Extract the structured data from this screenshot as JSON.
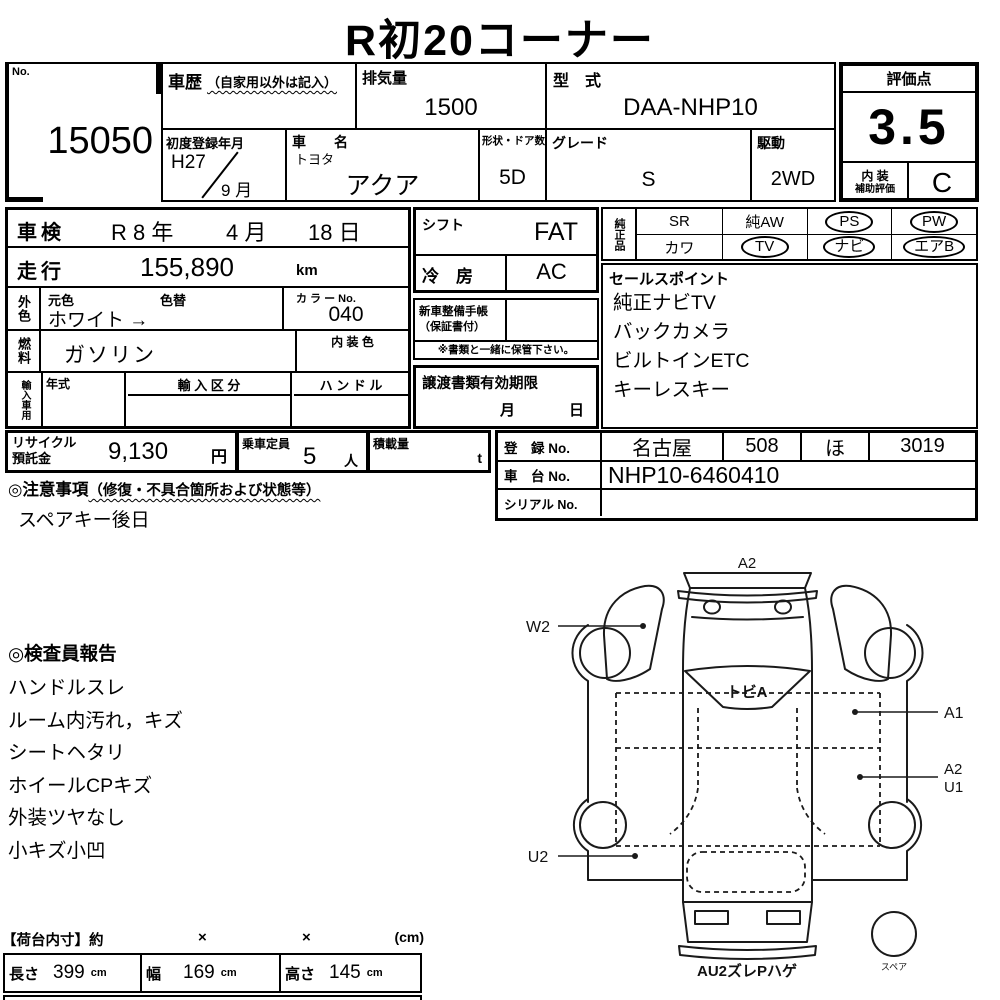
{
  "title": "R初20コーナー",
  "header": {
    "no": {
      "label": "No.",
      "value": "15050"
    },
    "history": {
      "label": "車歴",
      "note": "（自家用以外は記入）"
    },
    "displacement": {
      "label": "排気量",
      "value": "1500"
    },
    "model_code": {
      "label": "型　式",
      "value": "DAA-NHP10"
    },
    "first_reg": {
      "label": "初度登録年月",
      "year": "H27",
      "month": "9 月"
    },
    "car_name": {
      "label": "車　　名",
      "maker": "トヨタ",
      "model": "アクア"
    },
    "doors": {
      "label": "形状・ドア数",
      "value": "5D"
    },
    "grade": {
      "label": "グレード",
      "value": "S"
    },
    "drive": {
      "label": "駆動",
      "value": "2WD"
    }
  },
  "score": {
    "label": "評価点",
    "value": "3.5",
    "interior_label": "内 装",
    "interior_sublabel": "補助評価",
    "interior_value": "C"
  },
  "left": {
    "shaken": {
      "label": "車検",
      "year": "R 8 年",
      "month": "4 月",
      "day": "18 日"
    },
    "mileage": {
      "label": "走行",
      "value": "155,890",
      "unit": "km"
    },
    "ext_color": {
      "label": "外色",
      "orig_label": "元色",
      "change_label": "色替",
      "value": "ホワイト →",
      "color_no_label": "カ ラ ー No.",
      "color_no": "040"
    },
    "fuel": {
      "label": "燃料",
      "value": "ガソリン",
      "interior_color_label": "内 装 色"
    },
    "import": {
      "label": "輸入車用",
      "year_label": "年式",
      "division_label": "輸 入 区 分",
      "handle_label": "ハ ン ド ル"
    }
  },
  "middle": {
    "shift": {
      "label": "シフト",
      "value": "FAT"
    },
    "ac": {
      "label": "冷　房",
      "value": "AC"
    },
    "service_book": {
      "label1": "新車整備手帳",
      "label2": "（保証書付）",
      "note": "※書類と一緒に保管下さい。"
    },
    "transfer": {
      "label": "譲渡書類有効期限",
      "month": "月",
      "day": "日"
    }
  },
  "oem": {
    "label": "純正品",
    "row1": [
      {
        "label": "SR",
        "circled": false
      },
      {
        "label": "純AW",
        "circled": false
      },
      {
        "label": "PS",
        "circled": true
      },
      {
        "label": "PW",
        "circled": true
      }
    ],
    "row2": [
      {
        "label": "カワ",
        "circled": false
      },
      {
        "label": "TV",
        "circled": true
      },
      {
        "label": "ナビ",
        "circled": true
      },
      {
        "label": "エアB",
        "circled": true
      }
    ]
  },
  "sales": {
    "label": "セールスポイント",
    "items": [
      "純正ナビTV",
      "バックカメラ",
      "ビルトインETC",
      "キーレスキー"
    ]
  },
  "recycle": {
    "label1": "リサイクル",
    "label2": "預託金",
    "value": "9,130",
    "unit": "円"
  },
  "capacity": {
    "label": "乗車定員",
    "value": "5",
    "unit": "人"
  },
  "load": {
    "label": "積載量",
    "unit": "t"
  },
  "registration": {
    "reg": {
      "label": "登　録 No.",
      "area": "名古屋",
      "class_no": "508",
      "kana": "ほ",
      "number": "3019"
    },
    "chassis": {
      "label": "車　台 No.",
      "value": "NHP10-6460410"
    },
    "serial": {
      "label": "シリアル No.",
      "value": ""
    }
  },
  "caution": {
    "label": "◎注意事項",
    "note": "（修復・不具合箇所および状態等）",
    "text": "スペアキー後日"
  },
  "inspector": {
    "label": "◎検査員報告",
    "items": [
      "ハンドルスレ",
      "ルーム内汚れ，キズ",
      "シートヘタリ",
      "ホイールCPキズ",
      "外装ツヤなし",
      "小キズ小凹"
    ]
  },
  "dimensions": {
    "title": "【荷台内寸】約",
    "x1": "×",
    "x2": "×",
    "unit_note": "(cm)",
    "cm": "cm",
    "length_label": "長さ",
    "length": "399",
    "width_label": "幅",
    "width": "169",
    "height_label": "高さ",
    "height": "145"
  },
  "diagram": {
    "labels": {
      "front": "A2",
      "w2": "W2",
      "windshield": "トビA",
      "a1": "A1",
      "a2": "A2",
      "u1": "U1",
      "u2": "U2",
      "rear": "AU2ズレPハゲ",
      "spare": "スペア"
    }
  }
}
